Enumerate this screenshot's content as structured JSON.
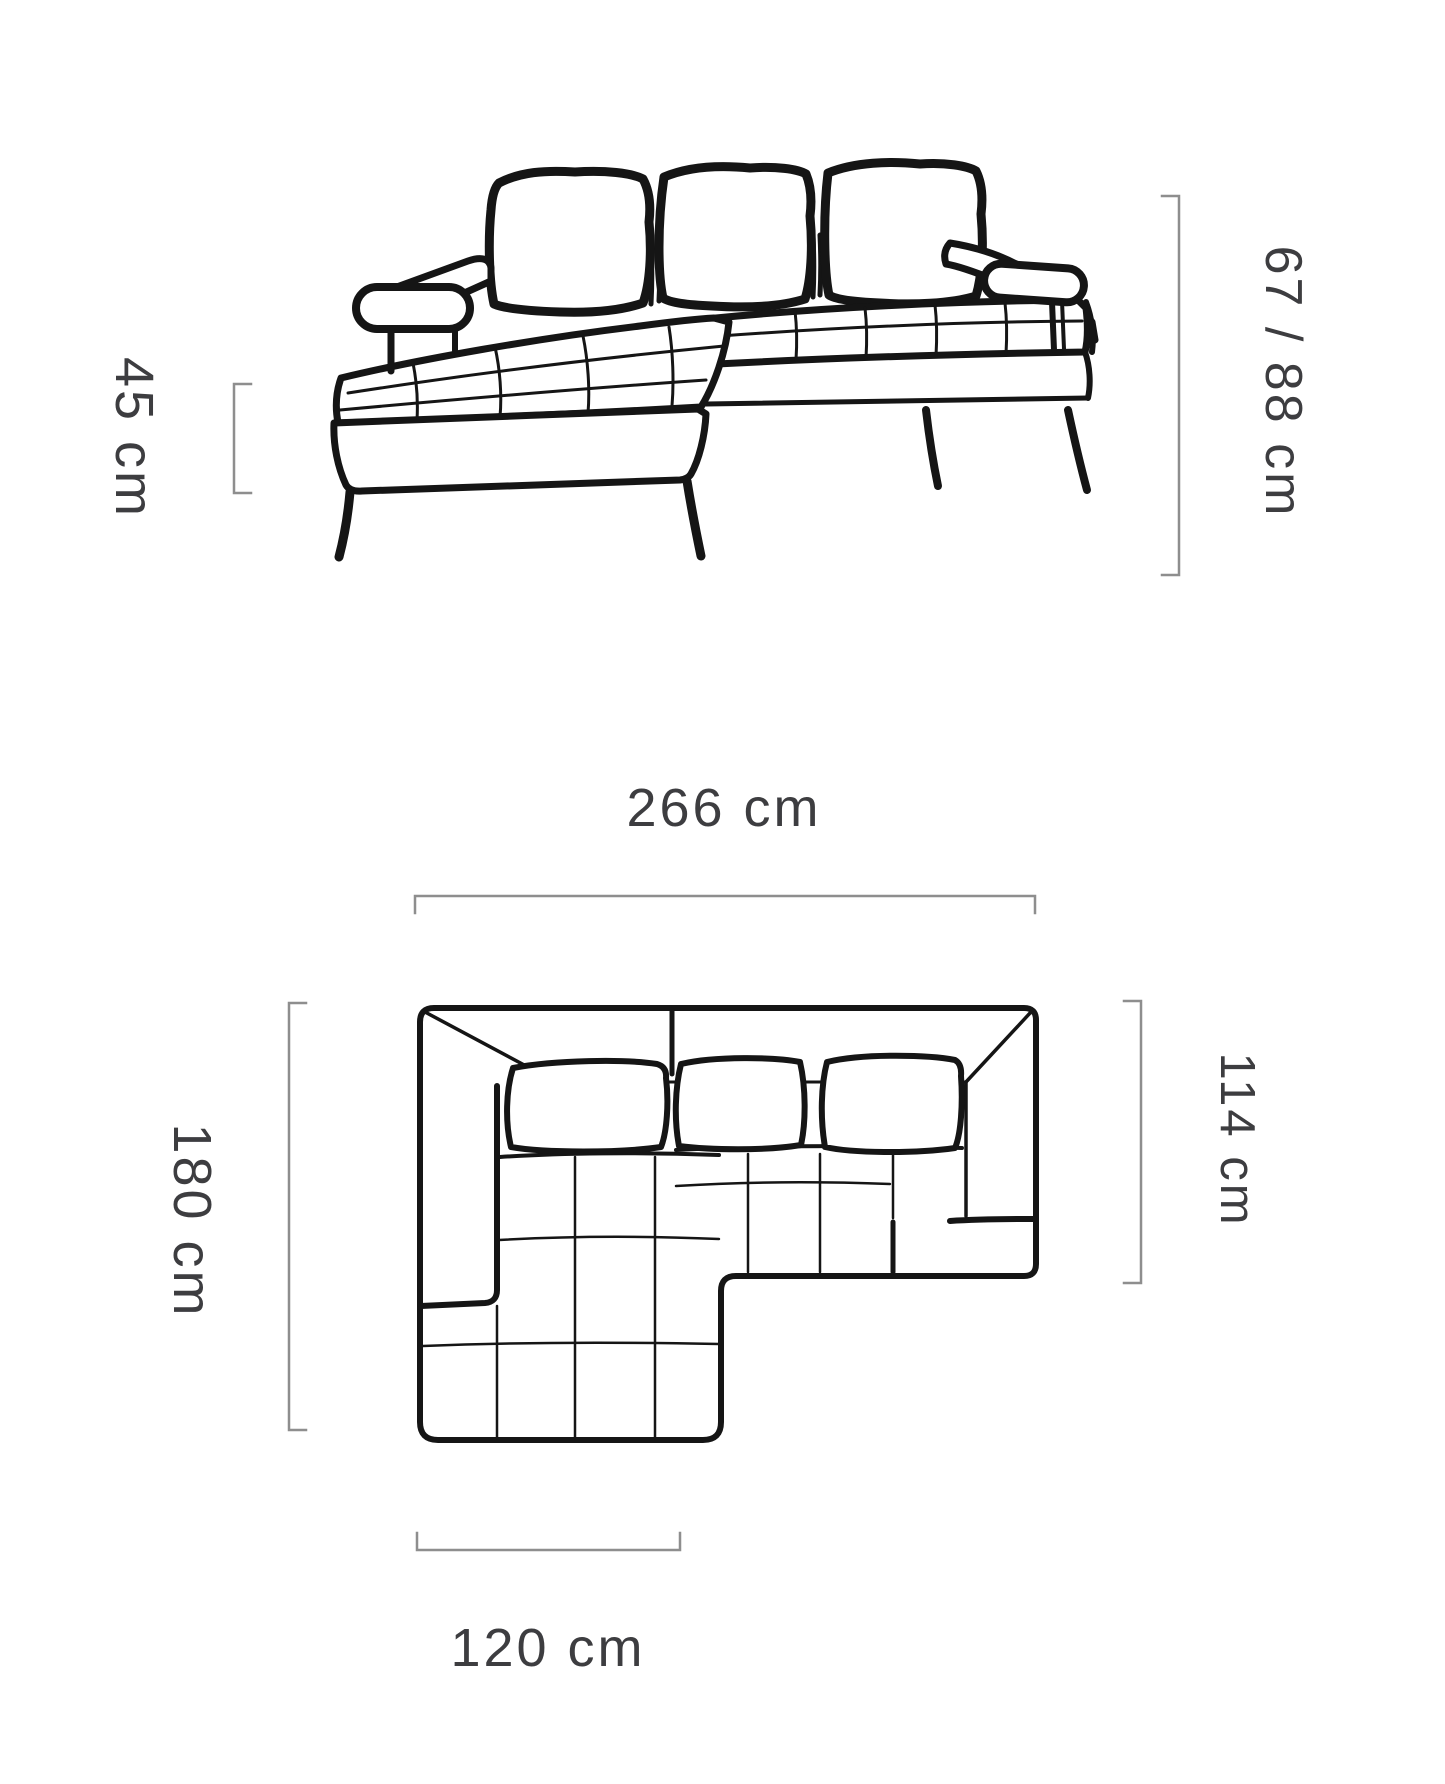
{
  "diagram": {
    "subject": "corner sofa dimension drawing",
    "views": {
      "front_view": "front elevation",
      "top_view": "top plan"
    }
  },
  "dimensions": {
    "seat_height": "45 cm",
    "back_height": "67 / 88 cm",
    "total_width": "266 cm",
    "total_depth": "180 cm",
    "body_depth": "114 cm",
    "chaise_width": "120 cm"
  },
  "colors": {
    "outline": "#151515",
    "measure_line": "#8e8e8e",
    "label_text": "#3d3d40",
    "background": "#ffffff"
  }
}
